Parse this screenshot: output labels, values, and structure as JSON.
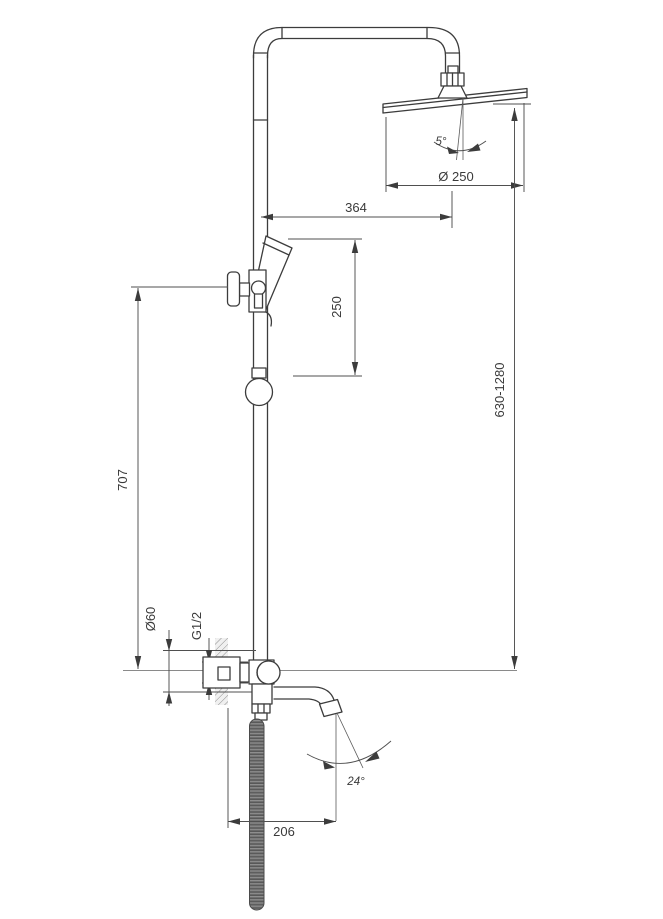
{
  "drawing": {
    "kind": "technical-dimension-drawing",
    "labels": {
      "head_tilt_angle": "5°",
      "head_diameter": "Ø 250",
      "arm_projection": "364",
      "hand_shower_offset": "250",
      "height_range": "630-1280",
      "rail_height": "707",
      "escutcheon_diameter": "Ø60",
      "connection_thread": "G1/2",
      "spout_angle": "24°",
      "spout_reach": "206"
    },
    "colors": {
      "line": "#3c3c3c",
      "dimension_line": "#4f4f4f",
      "text": "#3a3a3a",
      "hose": "#6a6a6a",
      "wall_hatch": "#8f8f8f",
      "background": "#ffffff"
    }
  }
}
